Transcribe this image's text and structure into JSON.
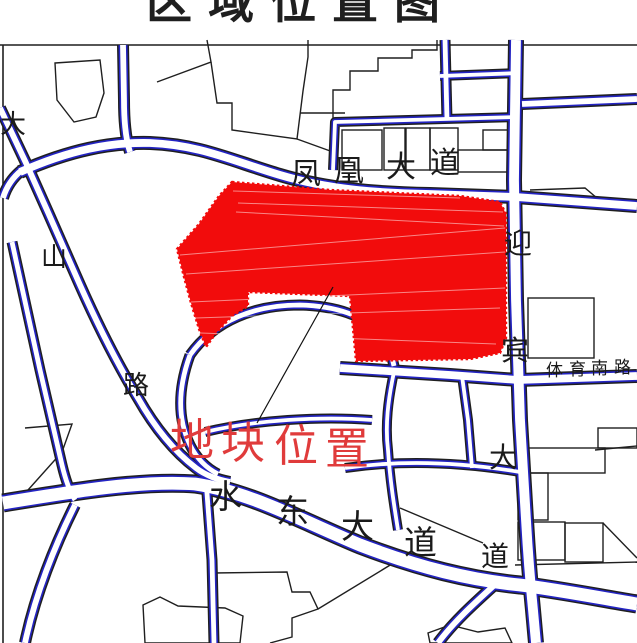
{
  "title": {
    "text": "区域位置图"
  },
  "map": {
    "colors": {
      "bg": "#ffffff",
      "parcel_red": "#f20c0c",
      "label_red": "#e03b3b",
      "road_blue": "#2424c3",
      "line_black": "#1f1f1f"
    },
    "parcel_label": {
      "text": "地块位置"
    },
    "roads": [
      {
        "name": "fenghuang-avenue",
        "text": "凤凰大道"
      },
      {
        "name": "yingbin-avenue",
        "text": "迎宾大道"
      },
      {
        "name": "tiyu-south-road",
        "text": "体育南路"
      },
      {
        "name": "shuidong-avenue",
        "text": "水东大道"
      },
      {
        "name": "dashan-road",
        "text": "大山路"
      }
    ],
    "labels": [
      {
        "name": "road-label-fenghuang",
        "size": 30,
        "color": "#1a1a1a",
        "chars": [
          {
            "c": "凤",
            "x": 291,
            "y": 160
          },
          {
            "c": "凰",
            "x": 334,
            "y": 157
          },
          {
            "c": "大",
            "x": 386,
            "y": 153
          },
          {
            "c": "道",
            "x": 430,
            "y": 149
          }
        ]
      },
      {
        "name": "road-label-yingbin",
        "size": 28,
        "color": "#1a1a1a",
        "chars": [
          {
            "c": "迎",
            "x": 504,
            "y": 231
          },
          {
            "c": "宾",
            "x": 501,
            "y": 338
          },
          {
            "c": "大",
            "x": 489,
            "y": 445
          },
          {
            "c": "道",
            "x": 481,
            "y": 544
          }
        ]
      },
      {
        "name": "road-label-tiyu",
        "size": 17,
        "color": "#1a1a1a",
        "chars": [
          {
            "c": "体",
            "x": 546,
            "y": 362
          },
          {
            "c": "育",
            "x": 569,
            "y": 361
          },
          {
            "c": "南",
            "x": 591,
            "y": 360
          },
          {
            "c": "路",
            "x": 614,
            "y": 359
          }
        ]
      },
      {
        "name": "road-label-shuidong",
        "size": 33,
        "color": "#1a1a1a",
        "chars": [
          {
            "c": "水",
            "x": 209,
            "y": 482
          },
          {
            "c": "东",
            "x": 276,
            "y": 497
          },
          {
            "c": "大",
            "x": 341,
            "y": 512
          },
          {
            "c": "道",
            "x": 404,
            "y": 528
          }
        ]
      },
      {
        "name": "road-label-dashan",
        "size": 26,
        "color": "#1a1a1a",
        "chars": [
          {
            "c": "大",
            "x": 0,
            "y": 112
          },
          {
            "c": "山",
            "x": 41,
            "y": 245
          },
          {
            "c": "路",
            "x": 123,
            "y": 373
          }
        ]
      },
      {
        "name": "parcel-location-label",
        "size": 44,
        "color": "#e03b3b",
        "chars": [
          {
            "c": "地",
            "x": 170,
            "y": 419
          },
          {
            "c": "块",
            "x": 221,
            "y": 422
          },
          {
            "c": "位",
            "x": 274,
            "y": 425
          },
          {
            "c": "置",
            "x": 325,
            "y": 428
          }
        ]
      }
    ]
  }
}
